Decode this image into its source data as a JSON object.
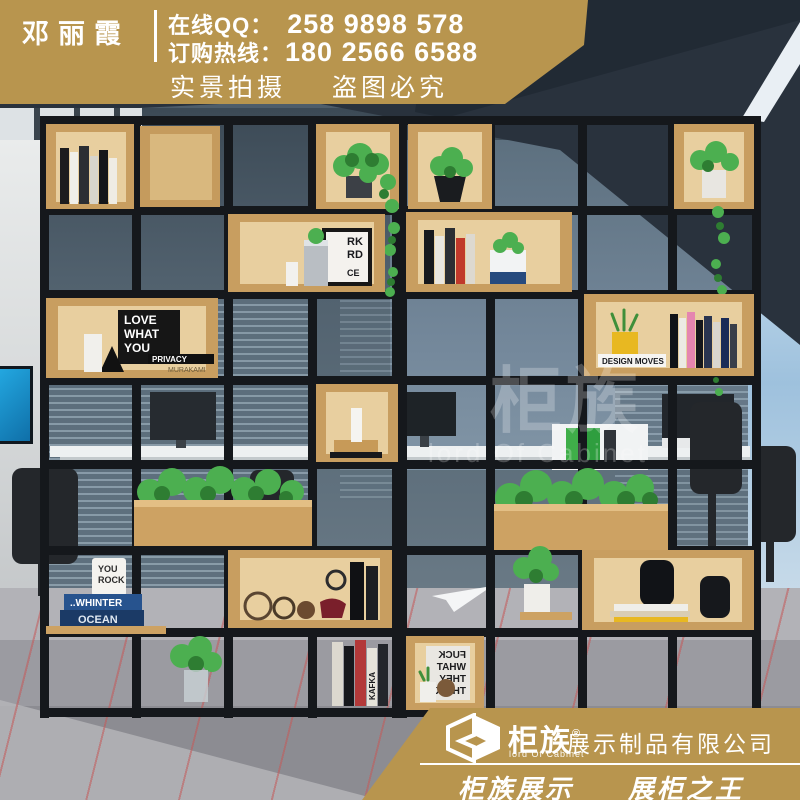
{
  "header": {
    "seller_name": "邓丽霞",
    "qq_label": "在线QQ：",
    "qq_number": "258 9898 578",
    "hotline_label": "订购热线：",
    "hotline_number": "180 2566 6588",
    "tagline_left": "实景拍摄",
    "tagline_right": "盗图必究"
  },
  "watermark": {
    "brand": "柜族",
    "sub": "lord Of Cabinet"
  },
  "footer": {
    "logo_text": "柜族",
    "logo_reg": "®",
    "logo_sub": "lord Of Cabinet",
    "company": "展示制品有限公司",
    "slogan_left": "柜族展示",
    "slogan_right": "展柜之王"
  },
  "scene": {
    "description": "black steel-frame display shelf room divider with wooden boxes, plants and books in a modern office",
    "decor_texts": {
      "poster_love": [
        "LOVE",
        "WHAT",
        "YOU"
      ],
      "privacy": "PRIVACY",
      "murakami": "MURAKAMI",
      "frame_work": [
        "RK",
        "RD",
        "CE"
      ],
      "book_design": "DESIGN MOVES",
      "book_winter": "..WHINTER",
      "book_ocean": "OCEAN",
      "mug": [
        "YOU",
        "ROCK"
      ],
      "book_kafka": "KAFKA",
      "poster_think": [
        "FUCK",
        "WHAT",
        "THEY",
        "THINK"
      ]
    },
    "colors": {
      "banner_gold": "#b8954e",
      "frame_black": "#15181c",
      "wood": "#cda263",
      "wood_light": "#e8cf9f",
      "ceiling": "#29323d",
      "glass": "#5d6e7c",
      "carpet": "#9b9ba1",
      "stripe_red": "#c45858",
      "window_blue": "#9ec1dd",
      "plant_green": "#4caf50"
    }
  }
}
